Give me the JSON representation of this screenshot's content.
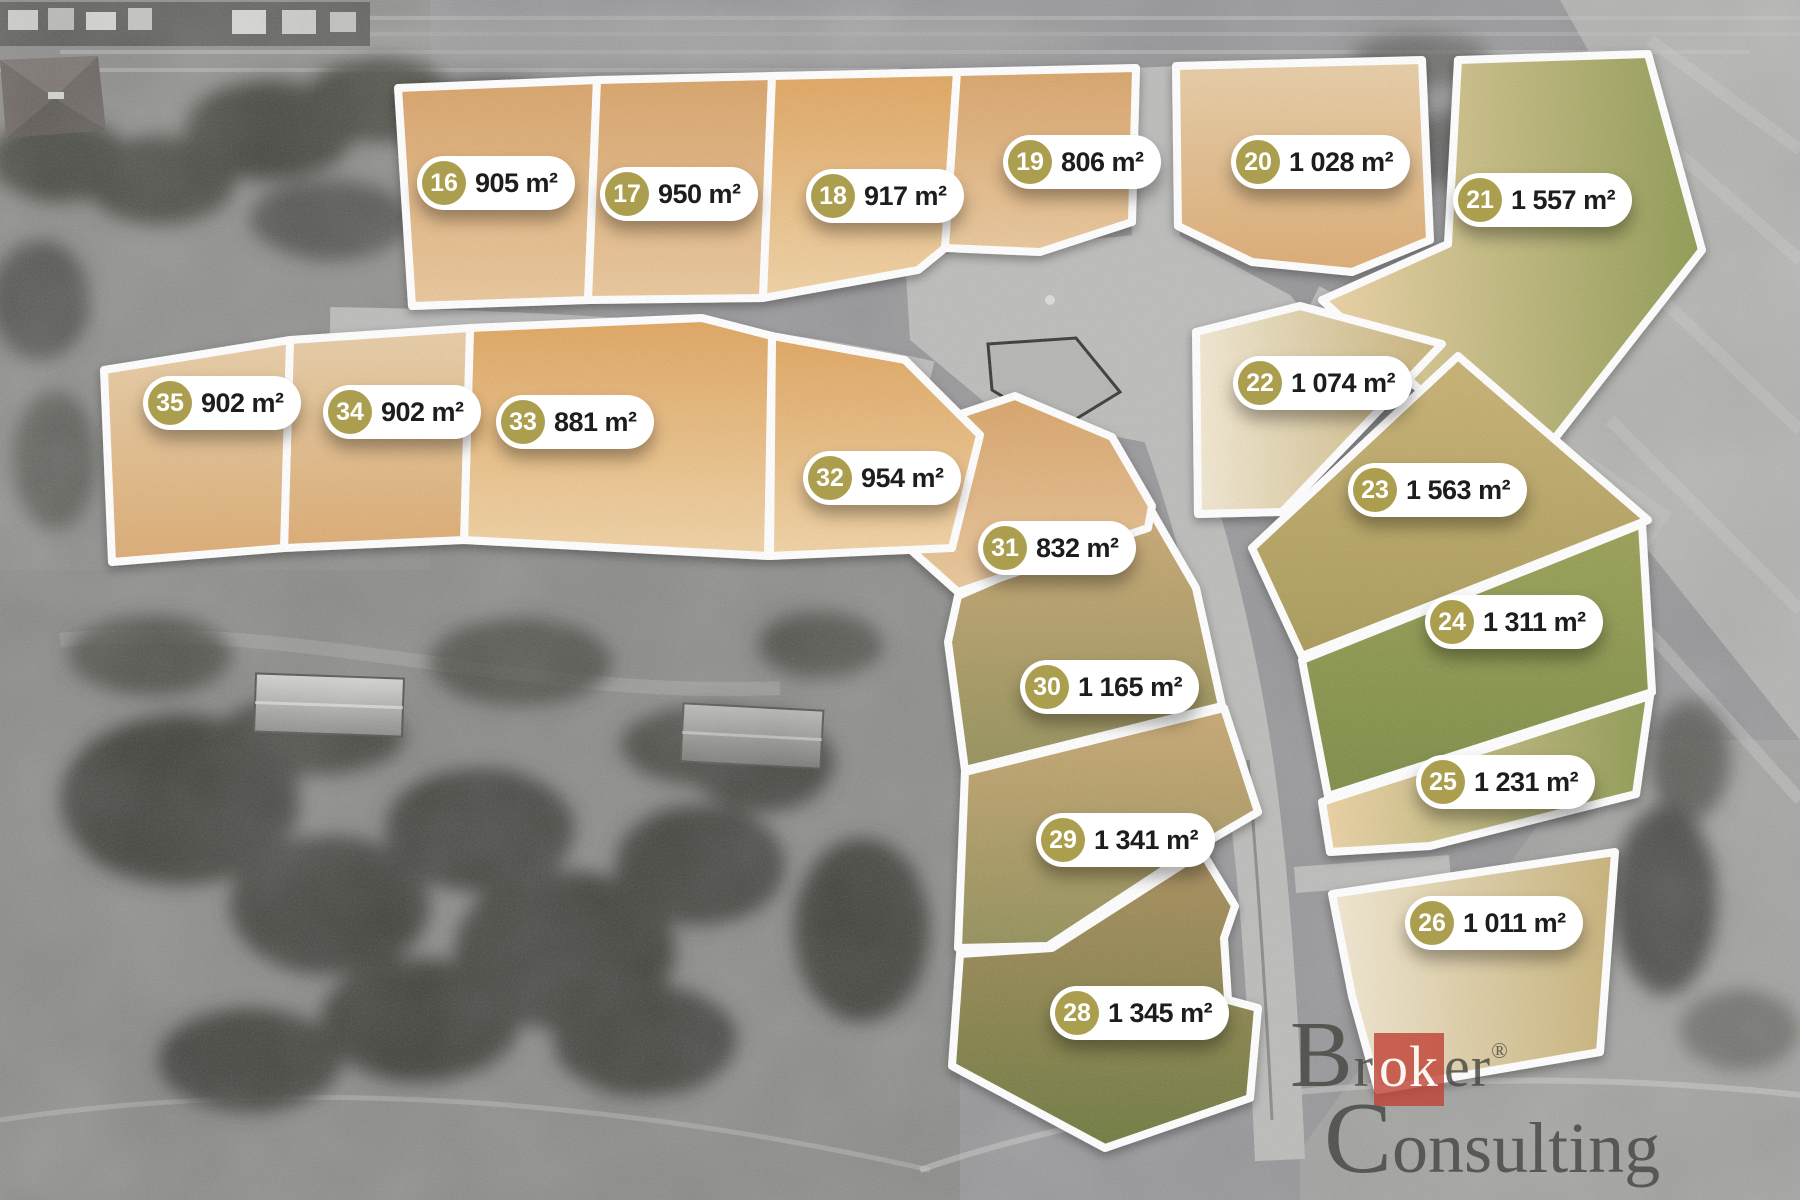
{
  "map": {
    "plots": [
      {
        "number": "16",
        "area": "905 m²",
        "x": 417,
        "y": 183,
        "tone": "sandA",
        "poly": "398,88 597,80 588,300 412,306"
      },
      {
        "number": "17",
        "area": "950 m²",
        "x": 600,
        "y": 194,
        "tone": "sandA",
        "poly": "597,80 772,76 763,298 588,300"
      },
      {
        "number": "18",
        "area": "917 m²",
        "x": 806,
        "y": 196,
        "tone": "sandB",
        "poly": "772,76 957,72 945,248 918,270 763,298"
      },
      {
        "number": "19",
        "area": "806 m²",
        "x": 1003,
        "y": 162,
        "tone": "sandA",
        "poly": "957,72 1136,68 1132,222 1040,252 945,248"
      },
      {
        "number": "20",
        "area": "1 028 m²",
        "x": 1231,
        "y": 162,
        "tone": "pale",
        "poly": "1176,66 1422,60 1430,240 1352,272 1252,262 1178,226"
      },
      {
        "number": "21",
        "area": "1 557 m²",
        "x": 1453,
        "y": 200,
        "tone": "sandgreen",
        "poly": "1458,60 1648,54 1702,250 1552,442 1470,436 1322,300 1448,244"
      },
      {
        "number": "22",
        "area": "1 074 m²",
        "x": 1233,
        "y": 383,
        "tone": "cream",
        "poly": "1196,332 1300,306 1442,344 1282,512 1198,514"
      },
      {
        "number": "23",
        "area": "1 563 m²",
        "x": 1348,
        "y": 490,
        "tone": "olive",
        "poly": "1252,548 1458,356 1648,520 1302,656"
      },
      {
        "number": "24",
        "area": "1 311 m²",
        "x": 1425,
        "y": 622,
        "tone": "green",
        "poly": "1302,660 1642,524 1652,692 1328,796"
      },
      {
        "number": "25",
        "area": "1 231 m²",
        "x": 1416,
        "y": 782,
        "tone": "sandgreen",
        "poly": "1322,802 1650,696 1636,794 1430,846 1330,852"
      },
      {
        "number": "26",
        "area": "1 011 m²",
        "x": 1405,
        "y": 923,
        "tone": "cream",
        "poly": "1332,894 1615,852 1600,1052 1378,1090 1352,996"
      },
      {
        "number": "28",
        "area": "1 345 m²",
        "x": 1050,
        "y": 1013,
        "tone": "brown",
        "poly": "960,954 1052,948 1202,852 1235,906 1224,938 1228,1000 1258,1008 1250,1098 1105,1148 952,1066"
      },
      {
        "number": "29",
        "area": "1 341 m²",
        "x": 1036,
        "y": 840,
        "tone": "mott",
        "poly": "965,772 1224,708 1258,812 1200,846 1048,946 958,948"
      },
      {
        "number": "30",
        "area": "1 165 m²",
        "x": 1020,
        "y": 687,
        "tone": "mott",
        "poly": "958,596 1152,512 1196,588 1222,706 965,770 948,642"
      },
      {
        "number": "31",
        "area": "832 m²",
        "x": 978,
        "y": 548,
        "tone": "sandA",
        "poly": "882,440 1015,396 1112,437 1152,506 1148,528 958,592 884,526"
      },
      {
        "number": "32",
        "area": "954 m²",
        "x": 803,
        "y": 478,
        "tone": "sandB",
        "poly": "772,336 905,360 980,435 952,548 770,556"
      },
      {
        "number": "33",
        "area": "881 m²",
        "x": 496,
        "y": 422,
        "tone": "sandB",
        "poly": "470,328 702,318 772,336 768,556 464,540"
      },
      {
        "number": "34",
        "area": "902 m²",
        "x": 323,
        "y": 412,
        "tone": "pale",
        "poly": "290,340 470,328 464,540 284,548"
      },
      {
        "number": "35",
        "area": "902 m²",
        "x": 143,
        "y": 403,
        "tone": "pale",
        "poly": "104,370 290,340 284,548 112,562"
      }
    ],
    "watermark": {
      "line1_pre": "Br",
      "line1_boxed": "ok",
      "line1_post": "er",
      "registered": "®",
      "line2": "Consulting"
    },
    "colors": {
      "badge": "#ab9f4f",
      "pill_bg": "#ffffff",
      "pill_text": "#1d1d1b",
      "plot_border": "#ffffff",
      "logo_red": "#c04236",
      "logo_text": "#44443f"
    }
  }
}
